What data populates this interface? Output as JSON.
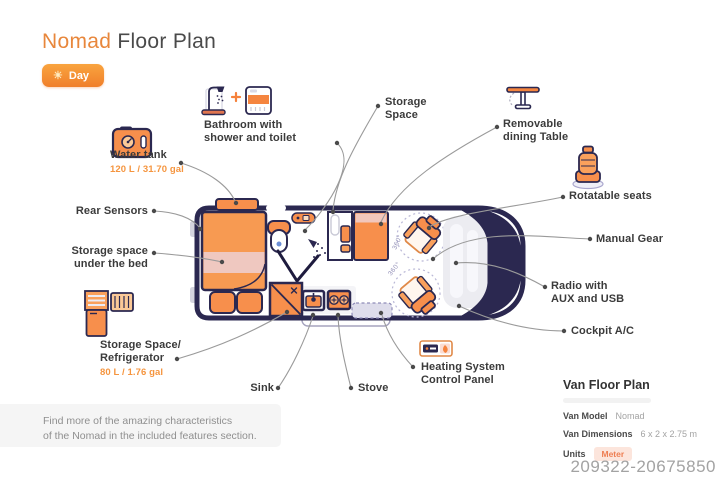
{
  "header": {
    "title_accent": "Nomad",
    "title_rest": "Floor Plan",
    "sun_icon": "☀",
    "mode_badge": "Day"
  },
  "labels": {
    "bathroom": {
      "l1": "Bathroom with",
      "l2": "shower and toilet"
    },
    "storage_space": {
      "l1": "Storage",
      "l2": "Space"
    },
    "dining_table": {
      "l1": "Removable",
      "l2": "dining Table"
    },
    "water_tank": {
      "name": "Water tank",
      "capacity": "120 L / 31.70 gal"
    },
    "rotatable_seats": "Rotatable seats",
    "rear_sensors": "Rear Sensors",
    "under_bed": {
      "l1": "Storage space",
      "l2": "under the bed"
    },
    "manual_gear": "Manual Gear",
    "radio": {
      "l1": "Radio with",
      "l2": "AUX and USB"
    },
    "fridge": {
      "l1": "Storage Space/",
      "l2": "Refrigerator",
      "capacity": "80 L / 1.76 gal"
    },
    "cockpit_ac": "Cockpit A/C",
    "sink": "Sink",
    "stove": "Stove",
    "heating": {
      "l1": "Heating System",
      "l2": "Control Panel"
    }
  },
  "floorplan": {
    "seat_rotation": "360°"
  },
  "van_info": {
    "title": "Van Floor Plan",
    "rows": [
      {
        "label": "Van Model",
        "value": "Nomad"
      },
      {
        "label": "Van Dimensions",
        "value": "6 x 2 x 2.75 m"
      },
      {
        "label": "Units",
        "value": "Meter"
      }
    ]
  },
  "footer_note": {
    "l1": "Find more of the amazing characteristics",
    "l2": "of the Nomad in the included features section."
  },
  "image_id": "209322-20675850",
  "colors": {
    "accent_orange": "#F5823C",
    "fill_orange": "#F78F4C",
    "navy": "#2B2850",
    "pink_band": "#EFC8C0",
    "leader_line": "#9A9A9A",
    "lavender": "#DEDDEB"
  }
}
